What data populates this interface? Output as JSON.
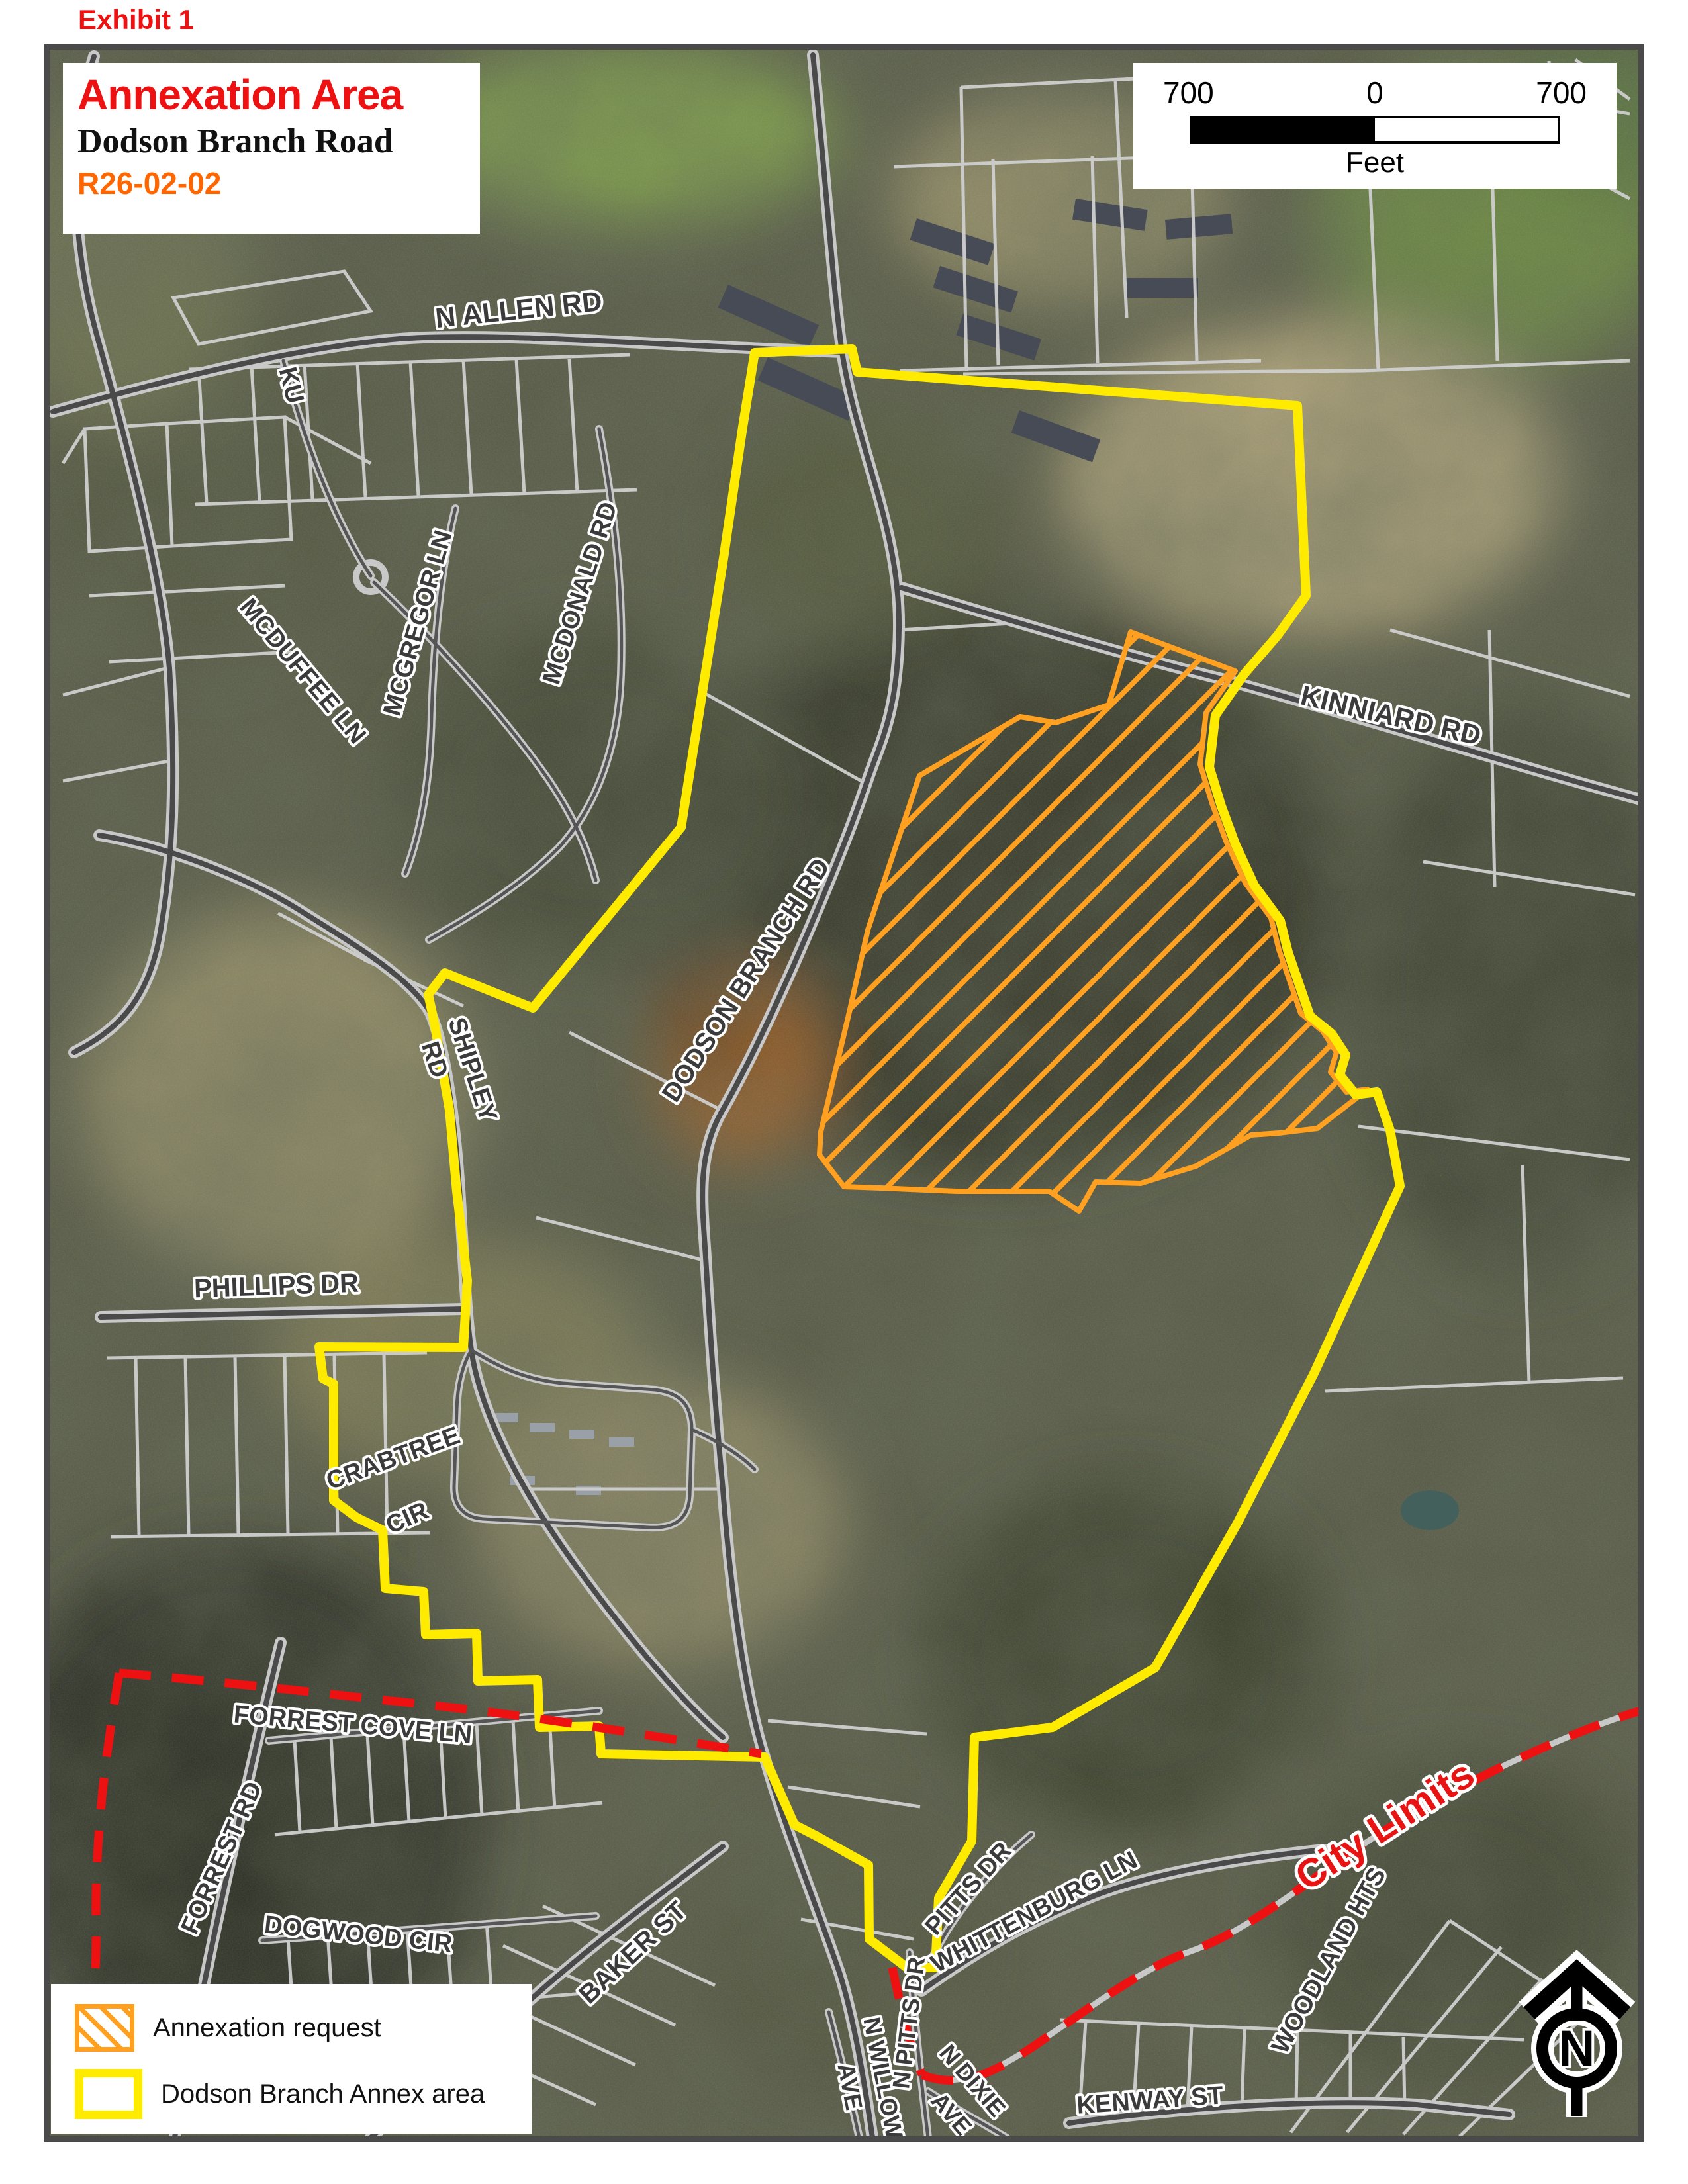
{
  "exhibit_label": "Exhibit 1",
  "title_box": {
    "title": "Annexation Area",
    "subtitle": "Dodson Branch Road",
    "case_number": "R26-02-02"
  },
  "scale_bar": {
    "left": "700",
    "center": "0",
    "right": "700",
    "units": "Feet"
  },
  "legend": {
    "items": [
      {
        "label": "Annexation request",
        "swatch": "orange-diagonal-hatch"
      },
      {
        "label": "Dodson Branch Annex area",
        "swatch": "yellow-outline"
      }
    ]
  },
  "north_arrow": {
    "letter": "N"
  },
  "city_limits_label": "City Limits",
  "colors": {
    "annexation_request": "#ffa020",
    "annex_area_boundary": "#ffeb00",
    "city_limits": "#ee1111",
    "exhibit_text": "#ee1111",
    "case_number_text": "#ff6600"
  },
  "road_labels": [
    {
      "text": "N ALLEN RD"
    },
    {
      "text": "KINNIARD RD"
    },
    {
      "text": "MCDUFFEE LN"
    },
    {
      "text": "MCGREGOR LN"
    },
    {
      "text": "MCDONALD RD"
    },
    {
      "text": "DODSON BRANCH RD"
    },
    {
      "text": "SHIPLEY"
    },
    {
      "text": "RD"
    },
    {
      "text": "PHILLIPS DR"
    },
    {
      "text": "CRABTREE"
    },
    {
      "text": "CIR"
    },
    {
      "text": "FORREST COVE LN"
    },
    {
      "text": "FORREST RD"
    },
    {
      "text": "DOGWOOD CIR"
    },
    {
      "text": "BAKER ST"
    },
    {
      "text": "PITTS DR"
    },
    {
      "text": "WHITTENBURG LN"
    },
    {
      "text": "N WILLOW"
    },
    {
      "text": "AVE"
    },
    {
      "text": "N PITTS DR"
    },
    {
      "text": "N DIXIE"
    },
    {
      "text": "AVE"
    },
    {
      "text": "KENWAY ST"
    },
    {
      "text": "WOODLAND HTS"
    },
    {
      "text": "KU"
    }
  ]
}
